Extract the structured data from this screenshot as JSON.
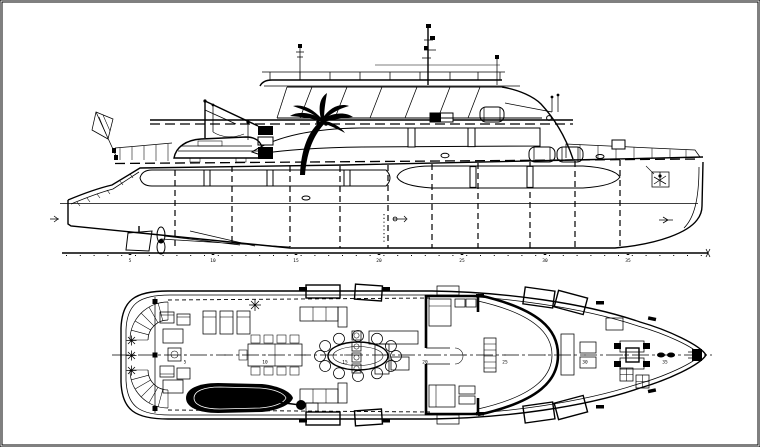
{
  "colors": {
    "background": "#ffffff",
    "ink": "#000000",
    "frame": "#000000"
  },
  "stations": {
    "labels": [
      "5",
      "10",
      "15",
      "20",
      "25",
      "30",
      "35"
    ]
  }
}
